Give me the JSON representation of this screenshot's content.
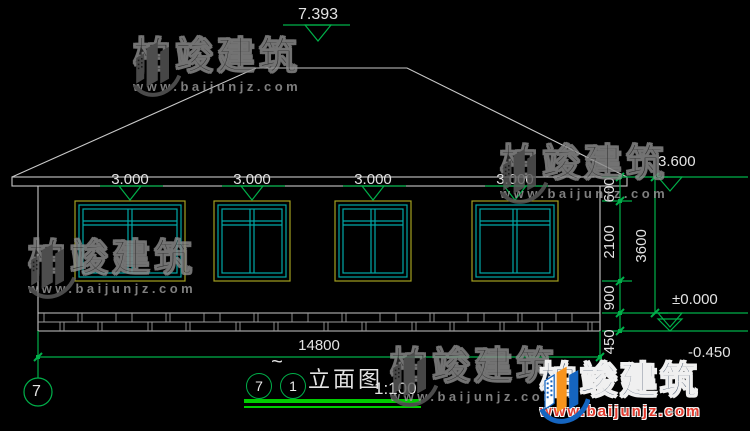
{
  "levels": {
    "ridge": "7.393",
    "eaves": [
      "3.000",
      "3.000",
      "3.000",
      "3.000"
    ],
    "eave_top": "3.600",
    "zero": "±0.000",
    "ground": "-0.450"
  },
  "dims": {
    "s600": "600",
    "s2100": "2100",
    "s900": "900",
    "s450": "450",
    "s3600": "3600",
    "total_width": "14800"
  },
  "axis": {
    "bubble": "7"
  },
  "titlebar": {
    "from": "7",
    "tilde": "~",
    "to": "1",
    "name": "立面图",
    "scale": "1:100"
  },
  "watermark": {
    "brand": "柏竣建筑",
    "url": "www.baijunjz.com"
  },
  "colors": {
    "background": "#000000",
    "line_white": "#c9c9c9",
    "roof_grid": "#4a4a4a",
    "plinth_joint": "#9b9b9b",
    "dim_green": "#00b04a",
    "underline_green": "#00cc00",
    "window_frame_yellow": "#a3a020",
    "window_frame_cyan": "#00a8a8",
    "logo_blue": "#1565c0",
    "logo_orange": "#f7941d",
    "logo_red": "#e23b2e"
  }
}
